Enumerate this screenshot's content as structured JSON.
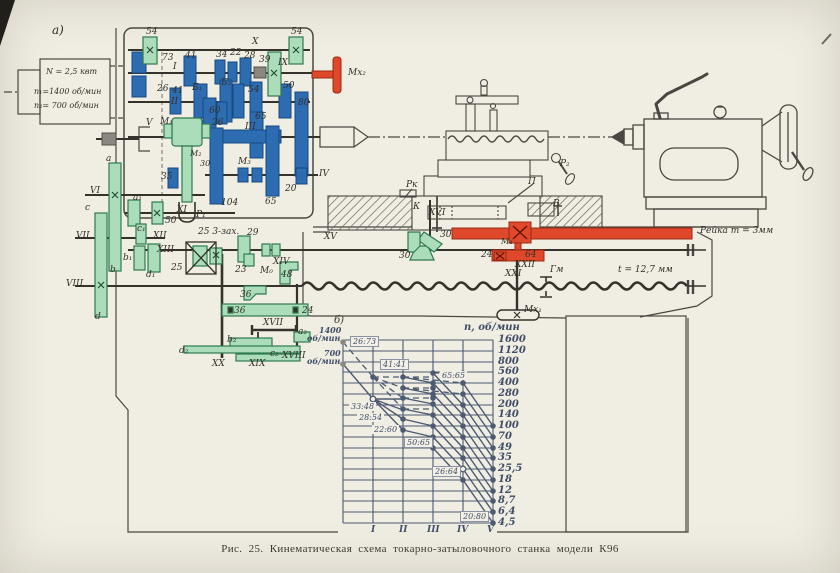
{
  "page": {
    "panel_a": "а)",
    "panel_b": "б)",
    "caption": "Рис. 25. Кинематическая схема токарно-затыловочного станка модели К96",
    "paper_color": "#f0ede3",
    "ink_color": "#3b3832",
    "gear_blue": "#2e6cb2",
    "gear_green": "#abddbb",
    "accent_red": "#e0482c",
    "chart_ink": "#4c5b72"
  },
  "motor": {
    "power": "N = 2,5 квт",
    "speed1": "n₁=1400 об/мин",
    "speed2": "n₂= 700 об/мин"
  },
  "shafts": {
    "i": "I",
    "ii": "II",
    "iii": "III",
    "iv": "IV",
    "v": "V",
    "vi": "VI",
    "vii": "VII",
    "viii": "VIII",
    "ix": "IX",
    "x": "X",
    "xi": "XI",
    "xii": "XII",
    "xiii": "XIII",
    "xiv": "XIV",
    "xv": "XV",
    "xvi": "XVI",
    "xvii": "XVII",
    "xviii": "XVIII",
    "xix": "XIX",
    "xx": "XX",
    "xxi": "XXI",
    "xxii": "XXII"
  },
  "gears": {
    "x54l": "54",
    "x54r": "54",
    "i73": "73",
    "i41": "41",
    "i34": "34",
    "i22": "22",
    "i28": "28",
    "i39": "39",
    "ii26": "26",
    "ii41": "41",
    "b1": "Б₁",
    "b2": "Б₂",
    "ii54": "54",
    "ii50": "50",
    "ii80": "80",
    "iii60": "60",
    "iii26": "26",
    "iii65": "65",
    "iii104": "104",
    "iv65": "65",
    "iv20": "20",
    "v35": "35",
    "m2_30": "30",
    "xi50": "50",
    "worm": "25 3-зах.",
    "worm25": "25",
    "w29": "29",
    "w23": "23",
    "w48": "48",
    "t36a": "36",
    "t36b": "36",
    "t24": "24",
    "bev30a": "30",
    "bev30b": "30",
    "r24": "24",
    "r64": "64"
  },
  "change_gears": {
    "a": "a",
    "b": "b",
    "c": "c",
    "d": "d",
    "a1": "a₁",
    "b1": "b₁",
    "c1": "c₁",
    "d1": "d₁",
    "a2": "a₂",
    "b2": "b₂",
    "c2": "c₂",
    "d2": "d₂"
  },
  "mech": {
    "m0": "М₀",
    "m1": "М₁",
    "m2": "М₂",
    "m3": "М₃",
    "m4": "М₄",
    "mx1": "Мх₁",
    "mx2": "Мх₂",
    "p1": "Р₁",
    "p2": "Р₂",
    "pk": "Рк",
    "k": "К",
    "p": "П",
    "v": "В",
    "gm": "Гм"
  },
  "annotations": {
    "rack": "Рейка m = 3мм",
    "pitch": "t = 12,7 мм"
  },
  "chart_data": {
    "type": "line",
    "subtype": "logarithmic speed ray diagram",
    "scale": "log",
    "grid": true,
    "ylabel": "n, об/мин",
    "x_categories": [
      "I",
      "II",
      "III",
      "IV",
      "V"
    ],
    "motor_points": [
      {
        "rpm": "1400",
        "unit": "об/мин",
        "value": 1400
      },
      {
        "rpm": "700",
        "unit": "об/мин",
        "value": 700
      }
    ],
    "spindle_speeds": [
      "1600",
      "1120",
      "800",
      "560",
      "400",
      "280",
      "200",
      "140",
      "100",
      "70",
      "49",
      "35",
      "25,5",
      "18",
      "12",
      "8,7",
      "6,4",
      "4,5"
    ],
    "speeds_rpm": [
      1600,
      1120,
      800,
      560,
      400,
      280,
      200,
      140,
      100,
      70,
      49,
      35,
      25.5,
      18,
      12,
      8.7,
      6.4,
      4.5
    ],
    "ratio_labels": [
      "26:73",
      "41:41",
      "65:65",
      "33:48",
      "28:54",
      "22:60",
      "50:65",
      "26:64",
      "20:80"
    ]
  }
}
